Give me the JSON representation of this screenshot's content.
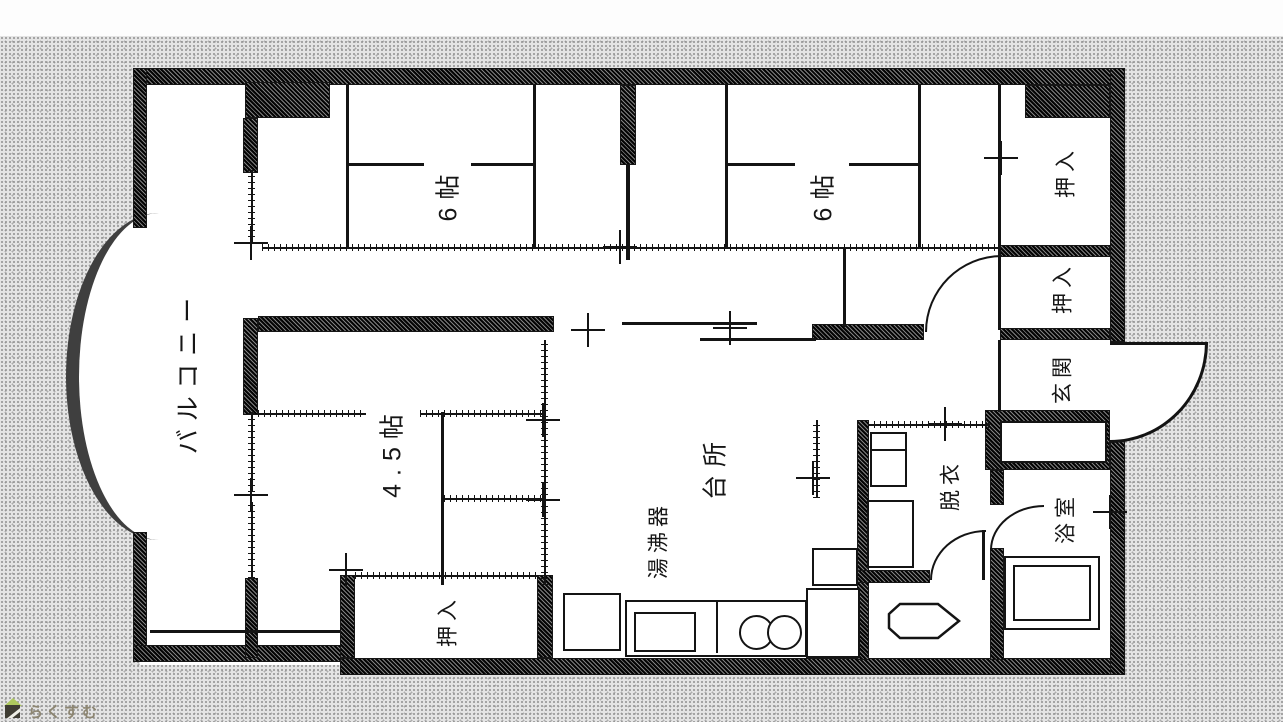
{
  "document": {
    "kind": "apartment floor plan scan"
  },
  "rooms": {
    "balcony": {
      "label": "バルコニー"
    },
    "bedroom1": {
      "label": "6帖"
    },
    "bedroom2": {
      "label": "6帖"
    },
    "bedroom3": {
      "label": "4.5帖"
    },
    "closet_top_right": {
      "label": "押入"
    },
    "closet_mid_right": {
      "label": "押入"
    },
    "closet_bottom": {
      "label": "押入"
    },
    "kitchen": {
      "label": "台所"
    },
    "water_heater": {
      "label": "湯沸器"
    },
    "entrance": {
      "label": "玄関"
    },
    "dressing": {
      "label": "脱衣"
    },
    "bathroom": {
      "label": "浴室"
    }
  },
  "fixtures": {
    "bathtub": "bathtub-icon",
    "toilet": "toilet-icon",
    "sink": "kitchen-sink-icon",
    "burners": "two-burner-stove-icon",
    "washer": "washing-machine-icon"
  },
  "watermark": {
    "text": "らくすむ",
    "icon": "house-icon",
    "text_color": "#8d8672",
    "roof_color": "#aec95e",
    "body_color": "#3f3d33"
  },
  "colors": {
    "background": "#e4e4e4",
    "floor": "#ffffff",
    "wall": "#4a4a4a",
    "line": "#141414"
  }
}
